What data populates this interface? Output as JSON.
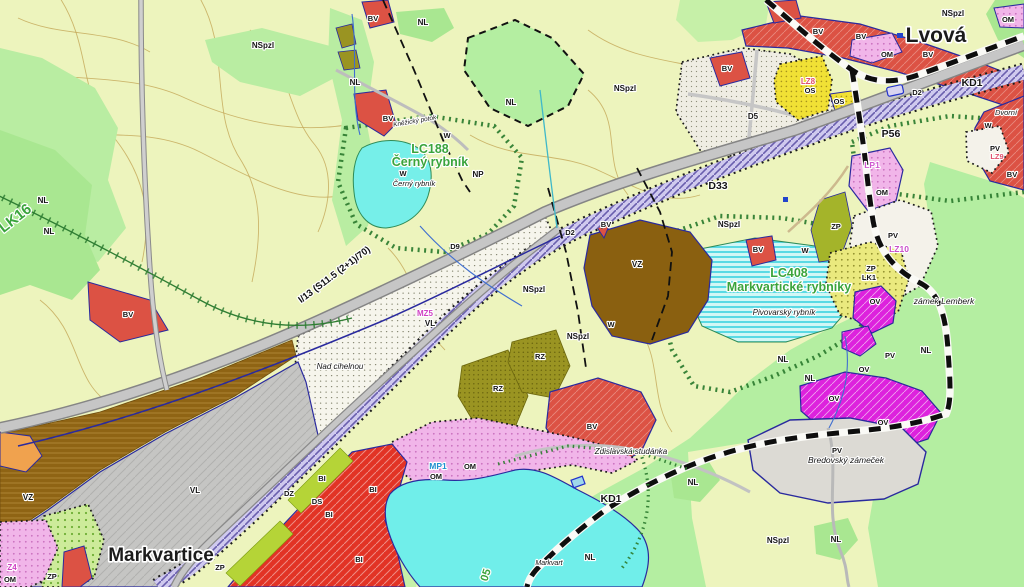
{
  "colors": {
    "background": "#edf4bd",
    "forest_green": "#b4eea1",
    "water_cyan": "#70eeea",
    "road_gray": "#c6c6c6",
    "rail_corridor_lavender": "#cfc9ee",
    "housing_red": "#dc5244",
    "housing_bi_red": "#e23325",
    "civic_magenta": "#dd22dd",
    "mixed_pink": "#f1b5e9",
    "sport_yellow": "#f1e135",
    "industry_gray": "#c5c5c3",
    "agri_brown": "#8f6414",
    "biocentre_text_green": "#3aa43c",
    "change_code_magenta": "#cf3fc3",
    "boundary_navy": "#2a2a9e"
  },
  "towns": {
    "lvova": "Lvová",
    "markvartice": "Markvartice"
  },
  "biocentres": {
    "lc188_line1": "LC188",
    "lc188_line2": "Černý rybník",
    "lc408_line1": "LC408",
    "lc408_line2": "Markvartické rybníky",
    "lk16": "LK16",
    "lc405_partial": "05"
  },
  "road_label": "I/13 (S11.5 (2+1)/70)",
  "labels": [
    {
      "n": "route-kd1-north",
      "t": "KD1",
      "x": 972,
      "y": 86,
      "s": 10.5
    },
    {
      "n": "route-kd1-south",
      "t": "KD1",
      "x": 611,
      "y": 502,
      "s": 10.5
    },
    {
      "n": "area-d33",
      "t": "D33",
      "x": 718,
      "y": 189,
      "s": 10.5
    },
    {
      "n": "area-p56",
      "t": "P56",
      "x": 891,
      "y": 137,
      "s": 10.5
    },
    {
      "n": "corridor-d2-east",
      "t": "D2",
      "x": 917,
      "y": 95,
      "s": 7.5
    },
    {
      "n": "corridor-d2-center",
      "t": "D2",
      "x": 570,
      "y": 235,
      "s": 7.5
    },
    {
      "n": "road-d9",
      "t": "D9",
      "x": 455,
      "y": 249,
      "s": 7.5
    },
    {
      "n": "area-d5",
      "t": "D5",
      "x": 753,
      "y": 119,
      "s": 8
    },
    {
      "n": "corridor-dz",
      "t": "DZ",
      "x": 289,
      "y": 496,
      "s": 7.5
    },
    {
      "n": "corridor-ds",
      "t": "DS",
      "x": 317,
      "y": 504,
      "s": 7.5
    },
    {
      "t": "NSpzl",
      "x": 263,
      "y": 48,
      "s": 8
    },
    {
      "t": "NSpzl",
      "x": 625,
      "y": 91,
      "s": 8
    },
    {
      "t": "NSpzl",
      "x": 953,
      "y": 16,
      "s": 8
    },
    {
      "t": "NSpzl",
      "x": 729,
      "y": 227,
      "s": 8
    },
    {
      "t": "NSpzl",
      "x": 534,
      "y": 292,
      "s": 8
    },
    {
      "t": "NSpzl",
      "x": 578,
      "y": 339,
      "s": 8
    },
    {
      "t": "NSpzl",
      "x": 778,
      "y": 543,
      "s": 8
    },
    {
      "t": "NL",
      "x": 43,
      "y": 203,
      "s": 8
    },
    {
      "t": "NL",
      "x": 49,
      "y": 234,
      "s": 8
    },
    {
      "t": "NL",
      "x": 423,
      "y": 25,
      "s": 8
    },
    {
      "t": "NL",
      "x": 355,
      "y": 85,
      "s": 8
    },
    {
      "t": "NL",
      "x": 511,
      "y": 105,
      "s": 8
    },
    {
      "t": "NL",
      "x": 783,
      "y": 362,
      "s": 8
    },
    {
      "t": "NL",
      "x": 810,
      "y": 381,
      "s": 8
    },
    {
      "t": "NL",
      "x": 926,
      "y": 353,
      "s": 8
    },
    {
      "t": "NL",
      "x": 693,
      "y": 485,
      "s": 8
    },
    {
      "t": "NL",
      "x": 836,
      "y": 542,
      "s": 8
    },
    {
      "t": "NL",
      "x": 590,
      "y": 560,
      "s": 8
    },
    {
      "t": "W",
      "x": 447,
      "y": 138,
      "s": 7.5
    },
    {
      "t": "W",
      "x": 403,
      "y": 176,
      "s": 7.5
    },
    {
      "t": "W",
      "x": 988,
      "y": 128,
      "s": 7.5
    },
    {
      "t": "W",
      "x": 805,
      "y": 253,
      "s": 7.5
    },
    {
      "t": "W",
      "x": 611,
      "y": 327,
      "s": 7.5
    },
    {
      "t": "NP",
      "x": 478,
      "y": 177,
      "s": 8
    },
    {
      "t": "BV",
      "x": 373,
      "y": 21,
      "s": 7.5
    },
    {
      "t": "BV",
      "x": 388,
      "y": 121,
      "s": 7.5
    },
    {
      "t": "BV",
      "x": 128,
      "y": 317,
      "s": 7.5
    },
    {
      "t": "BV",
      "x": 727,
      "y": 71,
      "s": 7.5
    },
    {
      "t": "BV",
      "x": 818,
      "y": 34,
      "s": 7.5
    },
    {
      "t": "BV",
      "x": 861,
      "y": 39,
      "s": 7.5
    },
    {
      "t": "BV",
      "x": 928,
      "y": 57,
      "s": 7.5
    },
    {
      "t": "BV",
      "x": 606,
      "y": 227,
      "s": 7.5
    },
    {
      "t": "BV",
      "x": 758,
      "y": 252,
      "s": 7.5
    },
    {
      "t": "BV",
      "x": 592,
      "y": 429,
      "s": 7.5
    },
    {
      "t": "BV",
      "x": 1012,
      "y": 177,
      "s": 7.5
    },
    {
      "t": "OM",
      "x": 887,
      "y": 57,
      "s": 7.5
    },
    {
      "t": "OM",
      "x": 1008,
      "y": 22,
      "s": 7.5
    },
    {
      "t": "OM",
      "x": 882,
      "y": 195,
      "s": 7.5
    },
    {
      "t": "OM",
      "x": 436,
      "y": 479,
      "s": 7.5
    },
    {
      "t": "OM",
      "x": 470,
      "y": 469,
      "s": 7.5
    },
    {
      "t": "OM",
      "x": 10,
      "y": 582,
      "s": 7.5
    },
    {
      "t": "OS",
      "x": 810,
      "y": 93,
      "s": 7.5
    },
    {
      "t": "OS",
      "x": 839,
      "y": 104,
      "s": 7.5
    },
    {
      "t": "VL",
      "x": 430,
      "y": 326,
      "s": 8
    },
    {
      "t": "VL",
      "x": 195,
      "y": 493,
      "s": 8
    },
    {
      "t": "VZ",
      "x": 637,
      "y": 267,
      "s": 8
    },
    {
      "t": "VZ",
      "x": 28,
      "y": 500,
      "s": 8
    },
    {
      "t": "RZ",
      "x": 498,
      "y": 391,
      "s": 7.5
    },
    {
      "t": "RZ",
      "x": 540,
      "y": 359,
      "s": 7.5
    },
    {
      "t": "BI",
      "x": 322,
      "y": 481,
      "s": 7.5
    },
    {
      "t": "BI",
      "x": 373,
      "y": 492,
      "s": 7.5
    },
    {
      "t": "BI",
      "x": 329,
      "y": 517,
      "s": 7.5
    },
    {
      "t": "BI",
      "x": 359,
      "y": 562,
      "s": 7.5
    },
    {
      "t": "ZP",
      "x": 836,
      "y": 229,
      "s": 7.5
    },
    {
      "t": "ZP",
      "x": 871,
      "y": 271,
      "s": 7.5
    },
    {
      "t": "ZP",
      "x": 220,
      "y": 570,
      "s": 7.5
    },
    {
      "t": "ZP",
      "x": 52,
      "y": 579,
      "s": 7.5
    },
    {
      "t": "LK1",
      "x": 869,
      "y": 280,
      "s": 7.5
    },
    {
      "t": "PV",
      "x": 995,
      "y": 151,
      "s": 7.5
    },
    {
      "t": "PV",
      "x": 893,
      "y": 238,
      "s": 7.5
    },
    {
      "t": "PV",
      "x": 890,
      "y": 358,
      "s": 7.5
    },
    {
      "t": "PV",
      "x": 837,
      "y": 453,
      "s": 7.5
    },
    {
      "t": "OV",
      "x": 875,
      "y": 304,
      "s": 7.5
    },
    {
      "t": "OV",
      "x": 864,
      "y": 372,
      "s": 7.5
    },
    {
      "t": "OV",
      "x": 834,
      "y": 401,
      "s": 7.5
    },
    {
      "t": "OV",
      "x": 883,
      "y": 425,
      "s": 7.5
    },
    {
      "n": "change-mz5",
      "t": "MZ5",
      "x": 425,
      "y": 316,
      "s": 8,
      "c": "#cf3fc3"
    },
    {
      "n": "change-lz8",
      "t": "LZ8",
      "x": 808,
      "y": 84,
      "s": 8,
      "c": "#e0506e"
    },
    {
      "n": "change-lz9",
      "t": "LZ9",
      "x": 997,
      "y": 159,
      "s": 7.5,
      "c": "#e0506e"
    },
    {
      "n": "change-lz10",
      "t": "LZ10",
      "x": 899,
      "y": 252,
      "s": 8.5,
      "c": "#c94fc9"
    },
    {
      "n": "change-lp1",
      "t": "LP1",
      "x": 872,
      "y": 168,
      "s": 8.5,
      "c": "#d058d0"
    },
    {
      "n": "change-z4",
      "t": "Z4",
      "x": 12,
      "y": 570,
      "s": 8,
      "c": "#cf3fc3"
    },
    {
      "n": "change-mp1",
      "t": "MP1",
      "x": 438,
      "y": 469,
      "s": 8.5,
      "c": "#2090d0"
    },
    {
      "n": "place-cerny-rybnik",
      "t": "Černý rybník",
      "x": 414,
      "y": 186,
      "s": 7.5,
      "i": 1
    },
    {
      "n": "place-nad-cihelnou",
      "t": "Nad cihelnou",
      "x": 340,
      "y": 369,
      "s": 8,
      "i": 1
    },
    {
      "n": "place-pivovarsky-rybnik",
      "t": "Pivovarský rybník",
      "x": 784,
      "y": 315,
      "s": 8,
      "i": 1
    },
    {
      "n": "place-zdislavska-studanka",
      "t": "Zdislavská studánka",
      "x": 631,
      "y": 454,
      "s": 8,
      "i": 1
    },
    {
      "n": "place-zamek-lemberk",
      "t": "zámek Lemberk",
      "x": 944,
      "y": 304,
      "s": 8.5,
      "i": 1
    },
    {
      "n": "place-bredovsky-zamecek",
      "t": "Bredovský zámeček",
      "x": 846,
      "y": 463,
      "s": 8.5,
      "i": 1
    },
    {
      "n": "place-dvorni",
      "t": "Dvorní",
      "x": 1006,
      "y": 115,
      "s": 7.5,
      "i": 1
    },
    {
      "n": "place-markvart",
      "t": "Markvart",
      "x": 549,
      "y": 565,
      "s": 7,
      "i": 1
    },
    {
      "n": "place-knezicky-potok",
      "t": "Kněžický potok",
      "x": 415,
      "y": 123,
      "s": 6.5,
      "i": 1,
      "r": -10
    }
  ]
}
